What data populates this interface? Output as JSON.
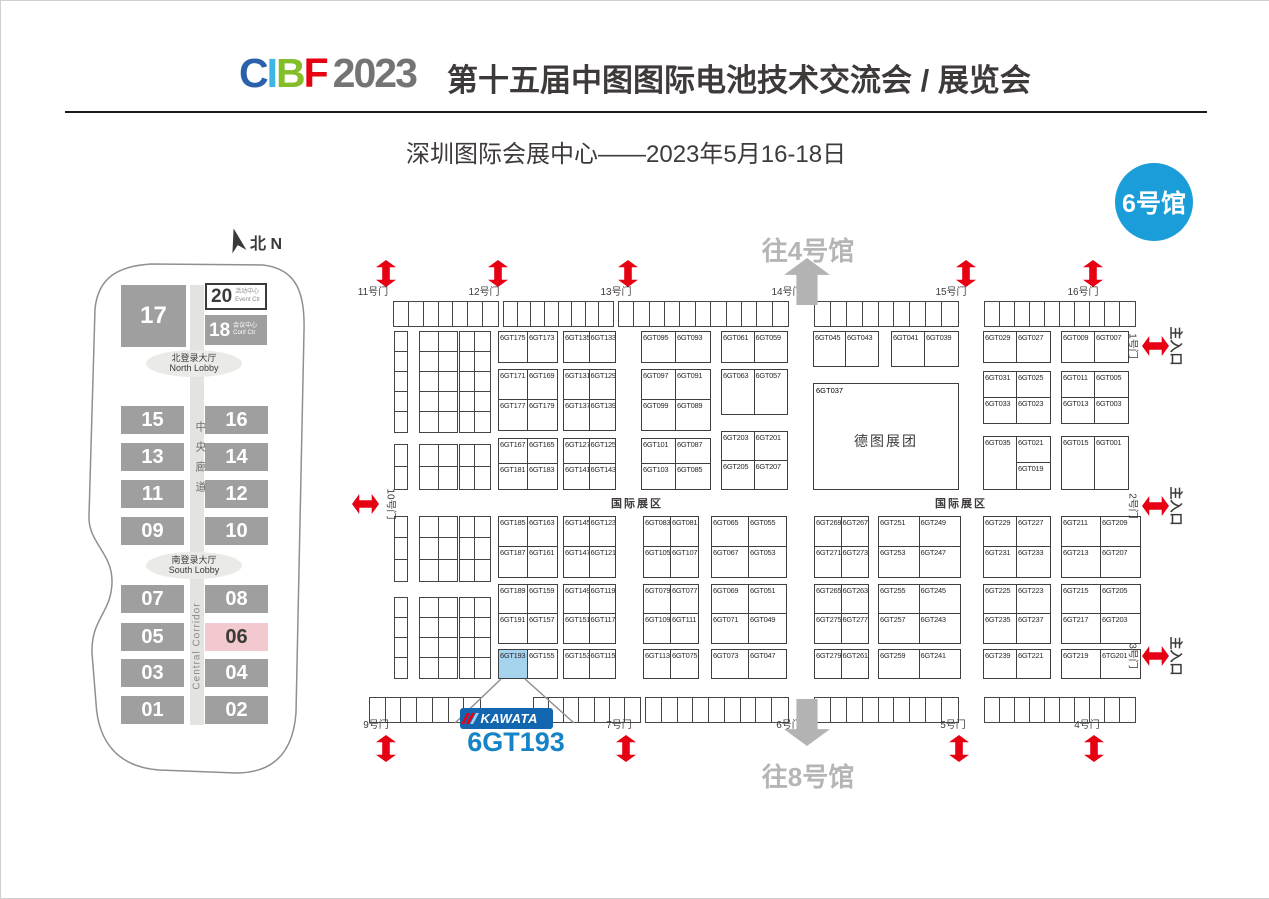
{
  "header": {
    "logo": {
      "c": "C",
      "i": "I",
      "b": "B",
      "f": "F",
      "year": "2023"
    },
    "title": "第十五届中图图际电池技术交流会 / 展览会",
    "subtitle": "深圳图际会展中心——2023年5月16-18日",
    "badge": "6号馆"
  },
  "overview": {
    "north": "北 N",
    "hall17": "17",
    "hall20": {
      "num": "20",
      "cn": "活动中心",
      "en": "Event Ctr"
    },
    "hall18": {
      "num": "18",
      "cn": "会议中心",
      "en": "Conf Ctr"
    },
    "north_lobby": {
      "cn": "北登录大厅",
      "en": "North Lobby"
    },
    "south_lobby": {
      "cn": "南登录大厅",
      "en": "South Lobby"
    },
    "corridor_cn": "中央廊道",
    "corridor_en": "Central Corridor",
    "highlight": "06",
    "pairs": [
      {
        "left": "15",
        "right": "16",
        "y": 405
      },
      {
        "left": "13",
        "right": "14",
        "y": 442
      },
      {
        "left": "11",
        "right": "12",
        "y": 479
      },
      {
        "left": "09",
        "right": "10",
        "y": 516
      },
      {
        "left": "07",
        "right": "08",
        "y": 584
      },
      {
        "left": "05",
        "right": "06",
        "y": 622
      },
      {
        "left": "03",
        "right": "04",
        "y": 658
      },
      {
        "left": "01",
        "right": "02",
        "y": 695
      }
    ]
  },
  "hall_map": {
    "to_hall_4": "往4号馆",
    "to_hall_8": "往8号馆",
    "international_zone": "国际展区",
    "international_zone_positions": [
      {
        "x": 636,
        "y": 502
      },
      {
        "x": 960,
        "y": 502
      }
    ],
    "gates_top": [
      {
        "label": "11号门",
        "x": 372
      },
      {
        "label": "12号门",
        "x": 483
      },
      {
        "label": "13号门",
        "x": 615
      },
      {
        "label": "14号门",
        "x": 786
      },
      {
        "label": "15号门",
        "x": 950
      },
      {
        "label": "16号门",
        "x": 1082
      }
    ],
    "gates_bottom": [
      {
        "label": "9号门",
        "x": 375
      },
      {
        "label": "7号门",
        "x": 618
      },
      {
        "label": "6号门",
        "x": 788
      },
      {
        "label": "5号门",
        "x": 952
      },
      {
        "label": "4号门",
        "x": 1086
      }
    ],
    "gate_left": {
      "label": "10号门",
      "x": 377,
      "y": 503
    },
    "gates_right": [
      {
        "gate": "1号门",
        "entrance": "主入口",
        "y": 345
      },
      {
        "gate": "2号门",
        "entrance": "主入口",
        "y": 505
      },
      {
        "gate": "3号门",
        "entrance": "主入口",
        "y": 655
      }
    ],
    "red_arrows": [
      {
        "x": 385,
        "y": 272,
        "dir": "v"
      },
      {
        "x": 497,
        "y": 272,
        "dir": "v"
      },
      {
        "x": 627,
        "y": 272,
        "dir": "v"
      },
      {
        "x": 965,
        "y": 272,
        "dir": "v"
      },
      {
        "x": 1092,
        "y": 272,
        "dir": "v"
      },
      {
        "x": 385,
        "y": 747,
        "dir": "v"
      },
      {
        "x": 625,
        "y": 747,
        "dir": "v"
      },
      {
        "x": 958,
        "y": 747,
        "dir": "v"
      },
      {
        "x": 1093,
        "y": 747,
        "dir": "v"
      },
      {
        "x": 364,
        "y": 503,
        "dir": "h"
      },
      {
        "x": 1154,
        "y": 345,
        "dir": "h"
      },
      {
        "x": 1154,
        "y": 505,
        "dir": "h"
      },
      {
        "x": 1154,
        "y": 655,
        "dir": "h"
      }
    ],
    "big_booth": {
      "x": 812,
      "y": 382,
      "w": 146,
      "h": 107,
      "id": "6GT037",
      "name": "德图展团"
    },
    "highlight_booth": "6GT193",
    "kawata_label": "KAWATA",
    "callout_booth": "6GT193",
    "blocks": [
      {
        "x": 497,
        "y": 330,
        "w": 60,
        "h": 32,
        "rows": [
          [
            "6GT175",
            "6GT173"
          ]
        ]
      },
      {
        "x": 497,
        "y": 368,
        "w": 60,
        "h": 62,
        "rows": [
          [
            "6GT171",
            "6GT169"
          ],
          [
            "6GT177",
            "6GT179"
          ]
        ]
      },
      {
        "x": 497,
        "y": 437,
        "w": 60,
        "h": 52,
        "rows": [
          [
            "6GT167",
            "6GT165"
          ],
          [
            "6GT181",
            "6GT183"
          ]
        ]
      },
      {
        "x": 562,
        "y": 330,
        "w": 53,
        "h": 32,
        "rows": [
          [
            "6GT135",
            "6GT133"
          ]
        ]
      },
      {
        "x": 562,
        "y": 368,
        "w": 53,
        "h": 62,
        "rows": [
          [
            "6GT131",
            "6GT129"
          ],
          [
            "6GT137",
            "6GT139"
          ]
        ]
      },
      {
        "x": 562,
        "y": 437,
        "w": 53,
        "h": 52,
        "rows": [
          [
            "6GT127",
            "6GT125"
          ],
          [
            "6GT141",
            "6GT143"
          ]
        ]
      },
      {
        "x": 640,
        "y": 330,
        "w": 70,
        "h": 32,
        "rows": [
          [
            "6GT095",
            "6GT093"
          ]
        ]
      },
      {
        "x": 640,
        "y": 368,
        "w": 70,
        "h": 62,
        "rows": [
          [
            "6GT097",
            "6GT091"
          ],
          [
            "6GT099",
            "6GT089"
          ]
        ]
      },
      {
        "x": 640,
        "y": 437,
        "w": 70,
        "h": 52,
        "rows": [
          [
            "6GT101",
            "6GT087"
          ],
          [
            "6GT103",
            "6GT085"
          ]
        ]
      },
      {
        "x": 720,
        "y": 330,
        "w": 67,
        "h": 32,
        "rows": [
          [
            "6GT061",
            "6GT059"
          ]
        ]
      },
      {
        "x": 720,
        "y": 368,
        "w": 67,
        "h": 46,
        "rows": [
          [
            "6GT063",
            "6GT057"
          ]
        ]
      },
      {
        "x": 720,
        "y": 430,
        "w": 67,
        "h": 59,
        "rows": [
          [
            "6GT203",
            "6GT201"
          ],
          [
            "6GT205",
            "6GT207"
          ]
        ]
      },
      {
        "x": 812,
        "y": 330,
        "w": 66,
        "h": 36,
        "rows": [
          [
            "6GT045",
            "6GT043"
          ]
        ]
      },
      {
        "x": 890,
        "y": 330,
        "w": 68,
        "h": 36,
        "rows": [
          [
            "6GT041",
            "6GT039"
          ]
        ]
      },
      {
        "x": 982,
        "y": 330,
        "w": 68,
        "h": 32,
        "rows": [
          [
            "6GT029",
            "6GT027"
          ]
        ]
      },
      {
        "x": 982,
        "y": 370,
        "w": 68,
        "h": 53,
        "rows": [
          [
            "6GT031",
            "6GT025"
          ],
          [
            "6GT033",
            "6GT023"
          ]
        ]
      },
      {
        "x": 982,
        "y": 435,
        "w": 68,
        "h": 54,
        "rows": [
          [
            "6GT035",
            "6GT021"
          ],
          [
            "^",
            "6GT019"
          ]
        ]
      },
      {
        "x": 1060,
        "y": 330,
        "w": 68,
        "h": 32,
        "rows": [
          [
            "6GT009",
            "6GT007"
          ]
        ]
      },
      {
        "x": 1060,
        "y": 370,
        "w": 68,
        "h": 53,
        "rows": [
          [
            "6GT011",
            "6GT005"
          ],
          [
            "6GT013",
            "6GT003"
          ]
        ]
      },
      {
        "x": 1060,
        "y": 435,
        "w": 68,
        "h": 54,
        "rows": [
          [
            "6GT015",
            "6GT001"
          ]
        ]
      },
      {
        "x": 497,
        "y": 515,
        "w": 60,
        "h": 62,
        "rows": [
          [
            "6GT185",
            "6GT163"
          ],
          [
            "6GT187",
            "6GT161"
          ]
        ]
      },
      {
        "x": 497,
        "y": 583,
        "w": 60,
        "h": 60,
        "rows": [
          [
            "6GT189",
            "6GT159"
          ],
          [
            "6GT191",
            "6GT157"
          ]
        ]
      },
      {
        "x": 497,
        "y": 648,
        "w": 60,
        "h": 30,
        "rows": [
          [
            "6GT193",
            "6GT155"
          ]
        ]
      },
      {
        "x": 562,
        "y": 515,
        "w": 53,
        "h": 62,
        "rows": [
          [
            "6GT145",
            "6GT123"
          ],
          [
            "6GT147",
            "6GT121"
          ]
        ]
      },
      {
        "x": 562,
        "y": 583,
        "w": 53,
        "h": 60,
        "rows": [
          [
            "6GT149",
            "6GT119"
          ],
          [
            "6GT151",
            "6GT117"
          ]
        ]
      },
      {
        "x": 562,
        "y": 648,
        "w": 53,
        "h": 30,
        "rows": [
          [
            "6GT153",
            "6GT115"
          ]
        ]
      },
      {
        "x": 642,
        "y": 515,
        "w": 56,
        "h": 62,
        "rows": [
          [
            "6GT083",
            "6GT081"
          ],
          [
            "6GT105",
            "6GT107"
          ]
        ]
      },
      {
        "x": 642,
        "y": 583,
        "w": 56,
        "h": 60,
        "rows": [
          [
            "6GT079",
            "6GT077"
          ],
          [
            "6GT109",
            "6GT111"
          ]
        ]
      },
      {
        "x": 642,
        "y": 648,
        "w": 56,
        "h": 30,
        "rows": [
          [
            "6GT113",
            "6GT075"
          ]
        ]
      },
      {
        "x": 710,
        "y": 515,
        "w": 76,
        "h": 62,
        "rows": [
          [
            "6GT065",
            "6GT055"
          ],
          [
            "6GT067",
            "6GT053"
          ]
        ]
      },
      {
        "x": 710,
        "y": 583,
        "w": 76,
        "h": 60,
        "rows": [
          [
            "6GT069",
            "6GT051"
          ],
          [
            "6GT071",
            "6GT049"
          ]
        ]
      },
      {
        "x": 710,
        "y": 648,
        "w": 76,
        "h": 30,
        "rows": [
          [
            "6GT073",
            "6GT047"
          ]
        ]
      },
      {
        "x": 813,
        "y": 515,
        "w": 55,
        "h": 62,
        "rows": [
          [
            "6GT269",
            "6GT267"
          ],
          [
            "6GT271",
            "6GT273"
          ]
        ]
      },
      {
        "x": 813,
        "y": 583,
        "w": 55,
        "h": 60,
        "rows": [
          [
            "6GT265",
            "6GT263"
          ],
          [
            "6GT275",
            "6GT277"
          ]
        ]
      },
      {
        "x": 813,
        "y": 648,
        "w": 55,
        "h": 30,
        "rows": [
          [
            "6GT279",
            "6GT261"
          ]
        ]
      },
      {
        "x": 877,
        "y": 515,
        "w": 83,
        "h": 62,
        "rows": [
          [
            "6GT251",
            "6GT249"
          ],
          [
            "6GT253",
            "6GT247"
          ]
        ]
      },
      {
        "x": 877,
        "y": 583,
        "w": 83,
        "h": 60,
        "rows": [
          [
            "6GT255",
            "6GT245"
          ],
          [
            "6GT257",
            "6GT243"
          ]
        ]
      },
      {
        "x": 877,
        "y": 648,
        "w": 83,
        "h": 30,
        "rows": [
          [
            "6GT259",
            "6GT241"
          ]
        ]
      },
      {
        "x": 982,
        "y": 515,
        "w": 68,
        "h": 62,
        "rows": [
          [
            "6GT229",
            "6GT227"
          ],
          [
            "6GT231",
            "6GT233"
          ]
        ]
      },
      {
        "x": 982,
        "y": 583,
        "w": 68,
        "h": 60,
        "rows": [
          [
            "6GT225",
            "6GT223"
          ],
          [
            "6GT235",
            "6GT237"
          ]
        ]
      },
      {
        "x": 982,
        "y": 648,
        "w": 68,
        "h": 30,
        "rows": [
          [
            "6GT239",
            "6GT221"
          ]
        ]
      },
      {
        "x": 1060,
        "y": 515,
        "w": 80,
        "h": 62,
        "rows": [
          [
            "6GT211",
            "6GT209"
          ],
          [
            "6GT213",
            "6GT207"
          ]
        ]
      },
      {
        "x": 1060,
        "y": 583,
        "w": 80,
        "h": 60,
        "rows": [
          [
            "6GT215",
            "6GT205"
          ],
          [
            "6GT217",
            "6GT203"
          ]
        ]
      },
      {
        "x": 1060,
        "y": 648,
        "w": 80,
        "h": 30,
        "rows": [
          [
            "6GT219",
            "6TG201"
          ]
        ]
      }
    ],
    "strips": [
      {
        "x": 392,
        "y": 300,
        "w": 106,
        "h": 26,
        "cols": 7,
        "rowsN": 1
      },
      {
        "x": 502,
        "y": 300,
        "w": 111,
        "h": 26,
        "cols": 8,
        "rowsN": 1
      },
      {
        "x": 617,
        "y": 300,
        "w": 171,
        "h": 26,
        "cols": 11,
        "rowsN": 1
      },
      {
        "x": 813,
        "y": 300,
        "w": 145,
        "h": 26,
        "cols": 9,
        "rowsN": 1
      },
      {
        "x": 983,
        "y": 300,
        "w": 152,
        "h": 26,
        "cols": 10,
        "rowsN": 1
      },
      {
        "x": 368,
        "y": 696,
        "w": 112,
        "h": 26,
        "cols": 7,
        "rowsN": 1
      },
      {
        "x": 532,
        "y": 696,
        "w": 108,
        "h": 26,
        "cols": 7,
        "rowsN": 1
      },
      {
        "x": 644,
        "y": 696,
        "w": 144,
        "h": 26,
        "cols": 9,
        "rowsN": 1
      },
      {
        "x": 813,
        "y": 696,
        "w": 145,
        "h": 26,
        "cols": 9,
        "rowsN": 1
      },
      {
        "x": 983,
        "y": 696,
        "w": 152,
        "h": 26,
        "cols": 10,
        "rowsN": 1
      },
      {
        "x": 393,
        "y": 330,
        "w": 14,
        "h": 102,
        "cols": 1,
        "rowsN": 5
      },
      {
        "x": 418,
        "y": 330,
        "w": 39,
        "h": 102,
        "cols": 2,
        "rowsN": 5
      },
      {
        "x": 458,
        "y": 330,
        "w": 32,
        "h": 102,
        "cols": 2,
        "rowsN": 5
      },
      {
        "x": 393,
        "y": 443,
        "w": 14,
        "h": 46,
        "cols": 1,
        "rowsN": 2
      },
      {
        "x": 418,
        "y": 443,
        "w": 39,
        "h": 46,
        "cols": 2,
        "rowsN": 2
      },
      {
        "x": 458,
        "y": 443,
        "w": 32,
        "h": 46,
        "cols": 2,
        "rowsN": 2
      },
      {
        "x": 393,
        "y": 515,
        "w": 14,
        "h": 66,
        "cols": 1,
        "rowsN": 3
      },
      {
        "x": 418,
        "y": 515,
        "w": 39,
        "h": 66,
        "cols": 2,
        "rowsN": 3
      },
      {
        "x": 458,
        "y": 515,
        "w": 32,
        "h": 66,
        "cols": 2,
        "rowsN": 3
      },
      {
        "x": 393,
        "y": 596,
        "w": 14,
        "h": 82,
        "cols": 1,
        "rowsN": 4
      },
      {
        "x": 418,
        "y": 596,
        "w": 39,
        "h": 82,
        "cols": 2,
        "rowsN": 4
      },
      {
        "x": 458,
        "y": 596,
        "w": 32,
        "h": 82,
        "cols": 2,
        "rowsN": 4
      }
    ]
  },
  "colors": {
    "red": "#e60012",
    "badge_blue": "#1b9dd9",
    "kawata_blue": "#1266b0",
    "callout_blue": "#1583c5",
    "highlight_booth": "#a6d3ee",
    "hall_gray": "#9f9f9f",
    "hall_pink": "#f1c9cf",
    "arrow_gray": "#b5b5b6",
    "title_dark": "#3e3a39"
  }
}
